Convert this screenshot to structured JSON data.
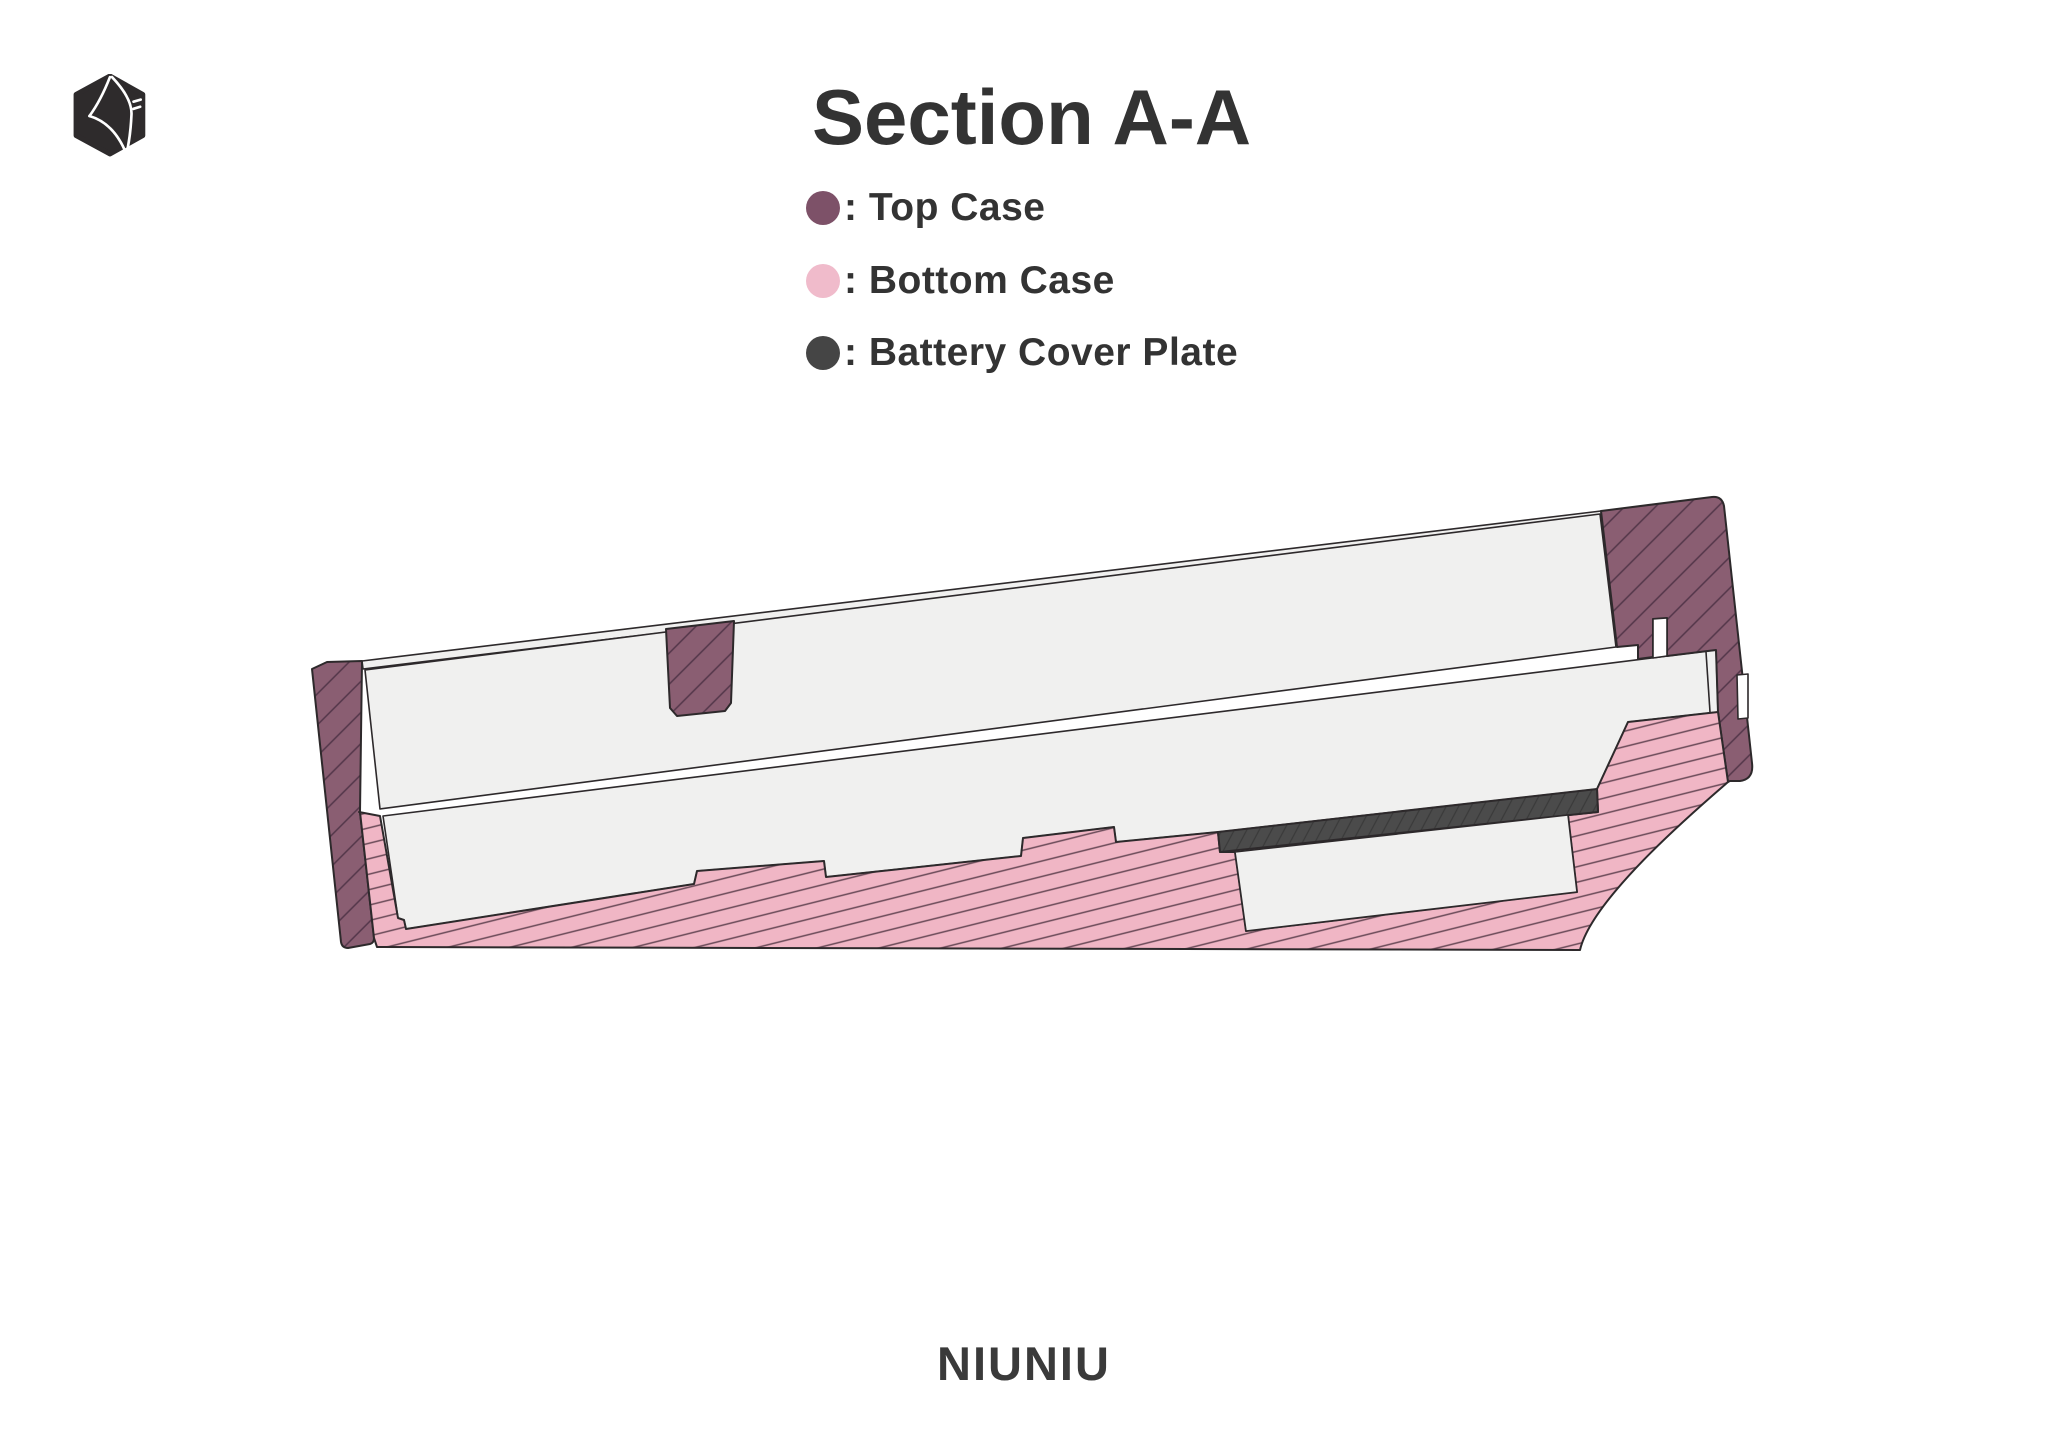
{
  "header": {
    "title": "Section A-A"
  },
  "legend": {
    "separator": ": ",
    "items": [
      {
        "label": "Top Case",
        "color_key": "top-case"
      },
      {
        "label": "Bottom Case",
        "color_key": "bottom-case"
      },
      {
        "label": "Battery Cover Plate",
        "color_key": "battery-cover-plate"
      }
    ]
  },
  "drawing": {
    "type": "engineering-cross-section",
    "parts": [
      "Top Case",
      "Bottom Case",
      "Battery Cover Plate"
    ],
    "logo_icon": "hexagon-cube-logo"
  },
  "footer": {
    "brand": "NIUNIU"
  },
  "theme": {
    "top-case": "#8A5E72",
    "bottom-case": "#F0B6C5",
    "battery-cover-plate": "#4B4B4B",
    "top-case-hatch": "#533649",
    "bottom-case-hatch": "#6A4A58",
    "plate-hatch": "#3A3A3A",
    "outline": "#2D292B",
    "slab": "#F0F0EF",
    "text": "#333333",
    "legend-top-case": "#7D5168",
    "legend-bottom-case": "#F0BBCB",
    "legend-plate": "#454545",
    "background": "#FFFFFF"
  }
}
